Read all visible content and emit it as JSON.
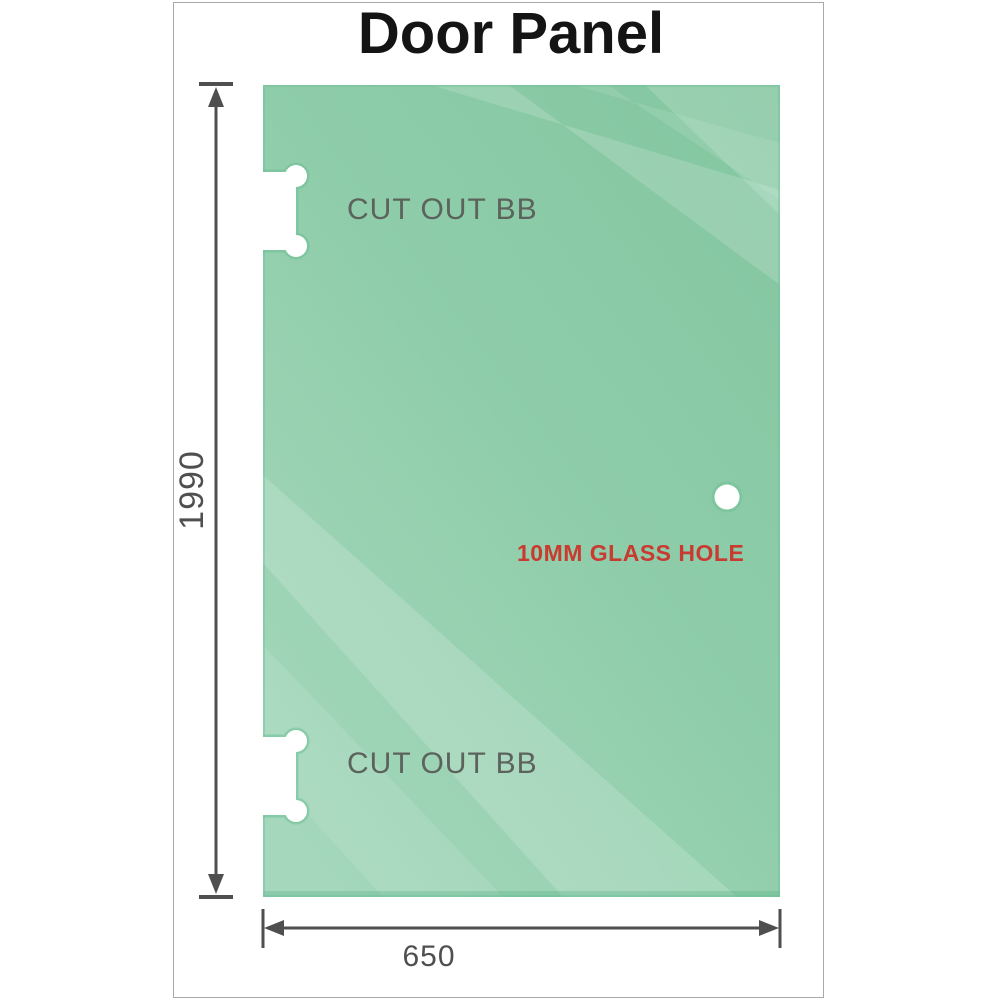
{
  "title": "Door Panel",
  "panel": {
    "top_cutout_label": "CUT OUT BB",
    "bottom_cutout_label": "CUT OUT BB",
    "glass_hole_label": "10MM GLASS HOLE"
  },
  "dimensions": {
    "height": "1990",
    "width": "650"
  },
  "colors": {
    "glass_top": "#83c6a0",
    "glass_mid": "#8fcdaa",
    "glass_bottom": "#a4d7bb",
    "glass_edge": "#6fc096",
    "dimension_line": "#4f4f4f",
    "cutout_label": "#5c625c",
    "hole_label": "#c93a31",
    "frame_border": "#a9a9a9"
  }
}
